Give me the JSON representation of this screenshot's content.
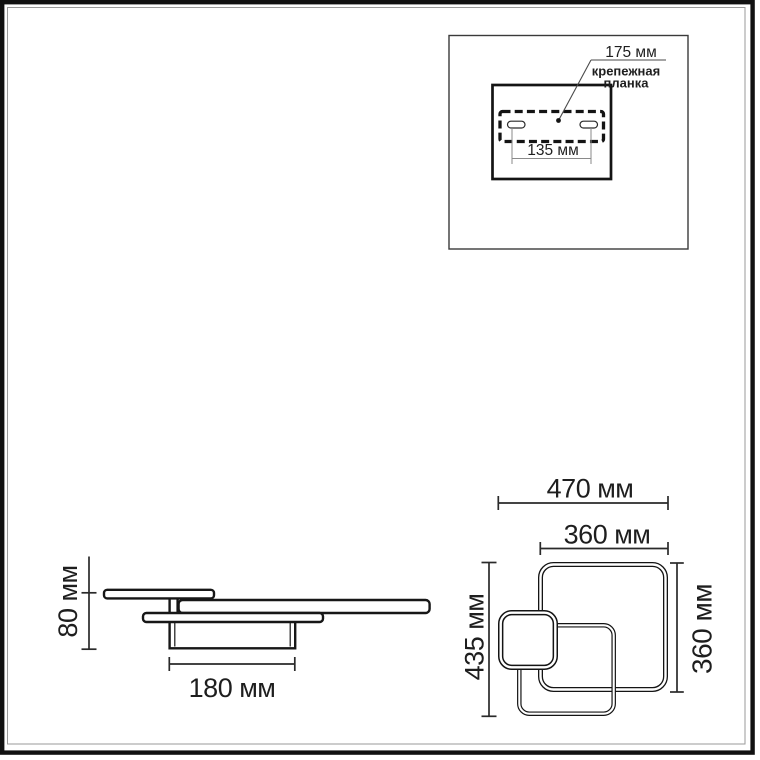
{
  "mounting_panel": {
    "dim_plate_width": "175 мм",
    "bracket_line1": "крепежная",
    "bracket_line2": "планка",
    "dim_holes_spacing": "135 мм"
  },
  "side_view": {
    "dim_height": "80 мм",
    "dim_base_width": "180 мм"
  },
  "front_view": {
    "dim_overall_width": "470 мм",
    "dim_large_frame_width": "360 мм",
    "dim_overall_height": "435 мм",
    "dim_large_frame_height": "360 мм"
  },
  "colors": {
    "background": "#ffffff",
    "object_line": "#171717",
    "dimension_line": "#2a2a2a",
    "inset_dimension_line": "#8a8a8a",
    "frame_border": "#111111",
    "frame_inner_line": "#9a9a9a"
  }
}
